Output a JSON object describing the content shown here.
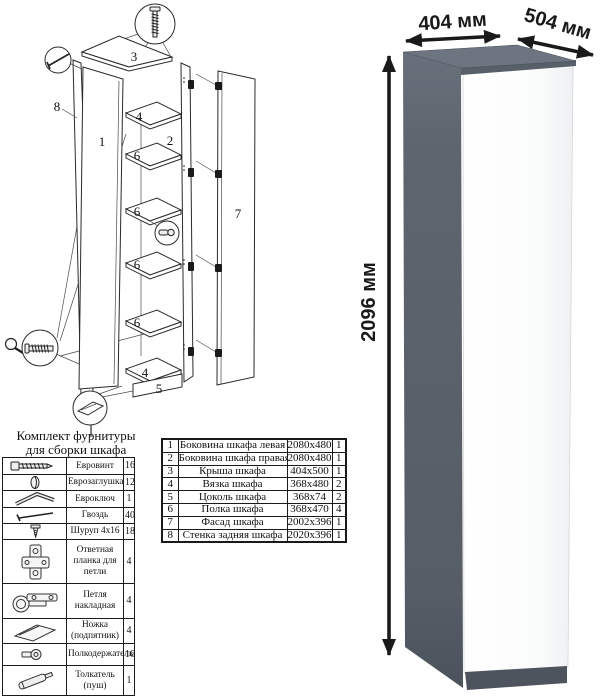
{
  "diagram": {
    "labels": {
      "top_panel": "3",
      "back_panel": "8",
      "left_side": "1",
      "top_tie": "4",
      "right_side": "2",
      "shelf_a": "6",
      "shelf_b": "6",
      "shelf_c": "6",
      "shelf_d": "6",
      "bottom_tie": "4",
      "plinth": "5",
      "door": "7"
    }
  },
  "hardware": {
    "title_line1": "Комплект фурнитуры",
    "title_line2": "для сборки шкафа",
    "rows": [
      {
        "icon": "euro-screw-icon",
        "name": "Евровинт",
        "qty": "16"
      },
      {
        "icon": "euro-cap-icon",
        "name": "Еврозаглушка",
        "qty": "12"
      },
      {
        "icon": "euro-key-icon",
        "name": "Евроключ",
        "qty": "1"
      },
      {
        "icon": "nail-icon",
        "name": "Гвоздь",
        "qty": "40"
      },
      {
        "icon": "screw-icon",
        "name": "Шуруп 4x16",
        "qty": "18"
      },
      {
        "icon": "hinge-plate-icon",
        "name": "Ответная планка для петли",
        "qty": "4"
      },
      {
        "icon": "hinge-icon",
        "name": "Петля накладная",
        "qty": "4"
      },
      {
        "icon": "foot-icon",
        "name": "Ножка (подпятник)",
        "qty": "4"
      },
      {
        "icon": "shelf-holder-icon",
        "name": "Полкодержатель",
        "qty": "16"
      },
      {
        "icon": "push-opener-icon",
        "name": "Толкатель (пуш)",
        "qty": "1"
      }
    ]
  },
  "parts": {
    "rows": [
      {
        "num": "1",
        "name": "Боковина шкафа левая",
        "size": "2080x480",
        "qty": "1"
      },
      {
        "num": "2",
        "name": "Боковина шкафа правая",
        "size": "2080x480",
        "qty": "1"
      },
      {
        "num": "3",
        "name": "Крыша шкафа",
        "size": "404x500",
        "qty": "1"
      },
      {
        "num": "4",
        "name": "Вязка шкафа",
        "size": "368x480",
        "qty": "2"
      },
      {
        "num": "5",
        "name": "Цоколь шкафа",
        "size": "368x74",
        "qty": "2"
      },
      {
        "num": "6",
        "name": "Полка шкафа",
        "size": "368x470",
        "qty": "4"
      },
      {
        "num": "7",
        "name": "Фасад шкафа",
        "size": "2002x396",
        "qty": "1"
      },
      {
        "num": "8",
        "name": "Стенка задняя шкафа",
        "size": "2020x396",
        "qty": "1"
      }
    ]
  },
  "dimensions": {
    "width": "404 мм",
    "depth": "504 мм",
    "height": "2096 мм"
  },
  "colors": {
    "cabinet_top": "#6d7580",
    "cabinet_top_edge": "#575f69",
    "cabinet_body": "#5c636d",
    "door": "#fbfcfd",
    "plinth": "#4d545e",
    "line": "#1a1a1a"
  }
}
